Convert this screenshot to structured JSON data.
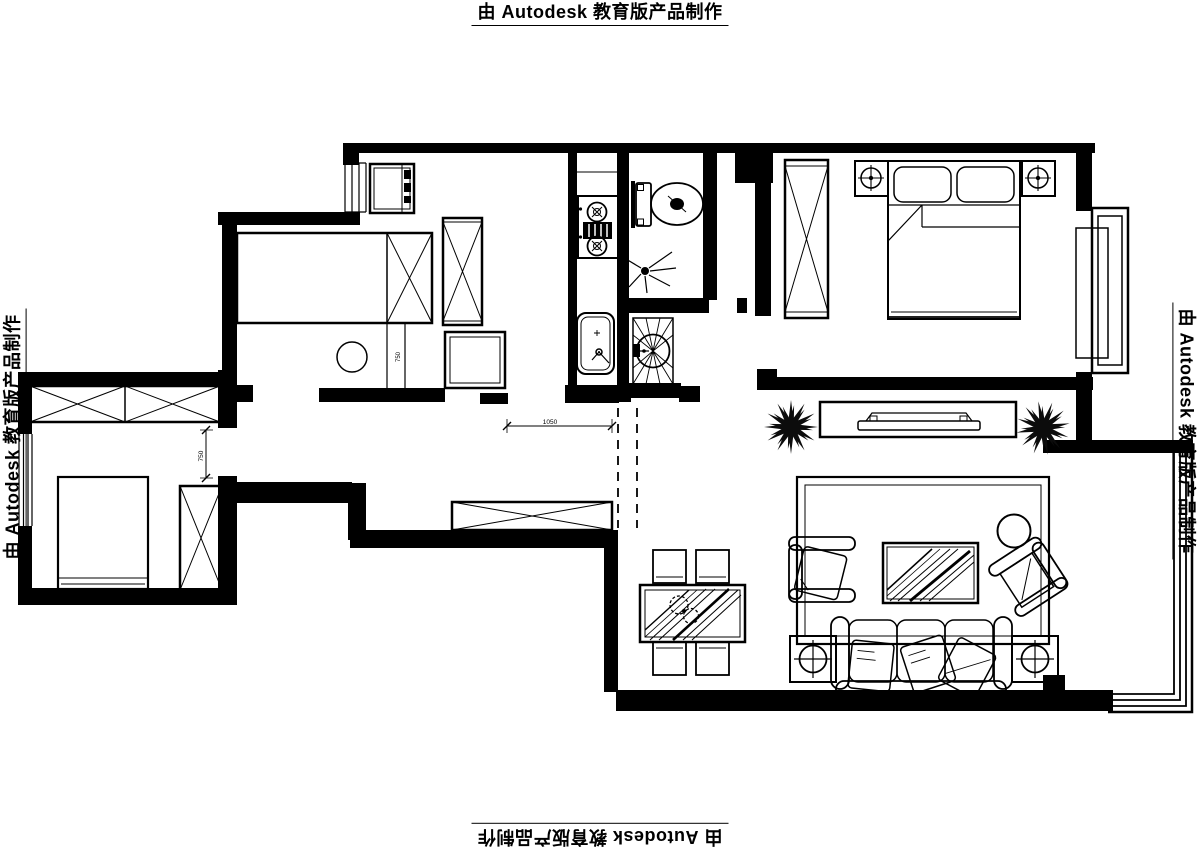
{
  "watermark": {
    "text": "由 Autodesk 教育版产品制作"
  },
  "dimensions": {
    "hall_opening": "1050",
    "bedroom_clearance": "750",
    "study_clearance": "750"
  },
  "symbols": [
    "fridge",
    "gas-stove",
    "kitchen-sink",
    "toilet",
    "shower-head",
    "washbasin",
    "wardrobe",
    "platform-bed",
    "stool",
    "desk",
    "double-bed",
    "bedside-lamp",
    "tv",
    "tv-cabinet",
    "potted-plant",
    "rug",
    "armchair",
    "coffee-table",
    "side-table",
    "round-table",
    "sofa",
    "throw-pillow",
    "dining-table",
    "dining-chair",
    "table-plant",
    "shoe-cabinet",
    "bay-window",
    "balcony-window",
    "entry-opening-dashed",
    "dimension-line"
  ]
}
